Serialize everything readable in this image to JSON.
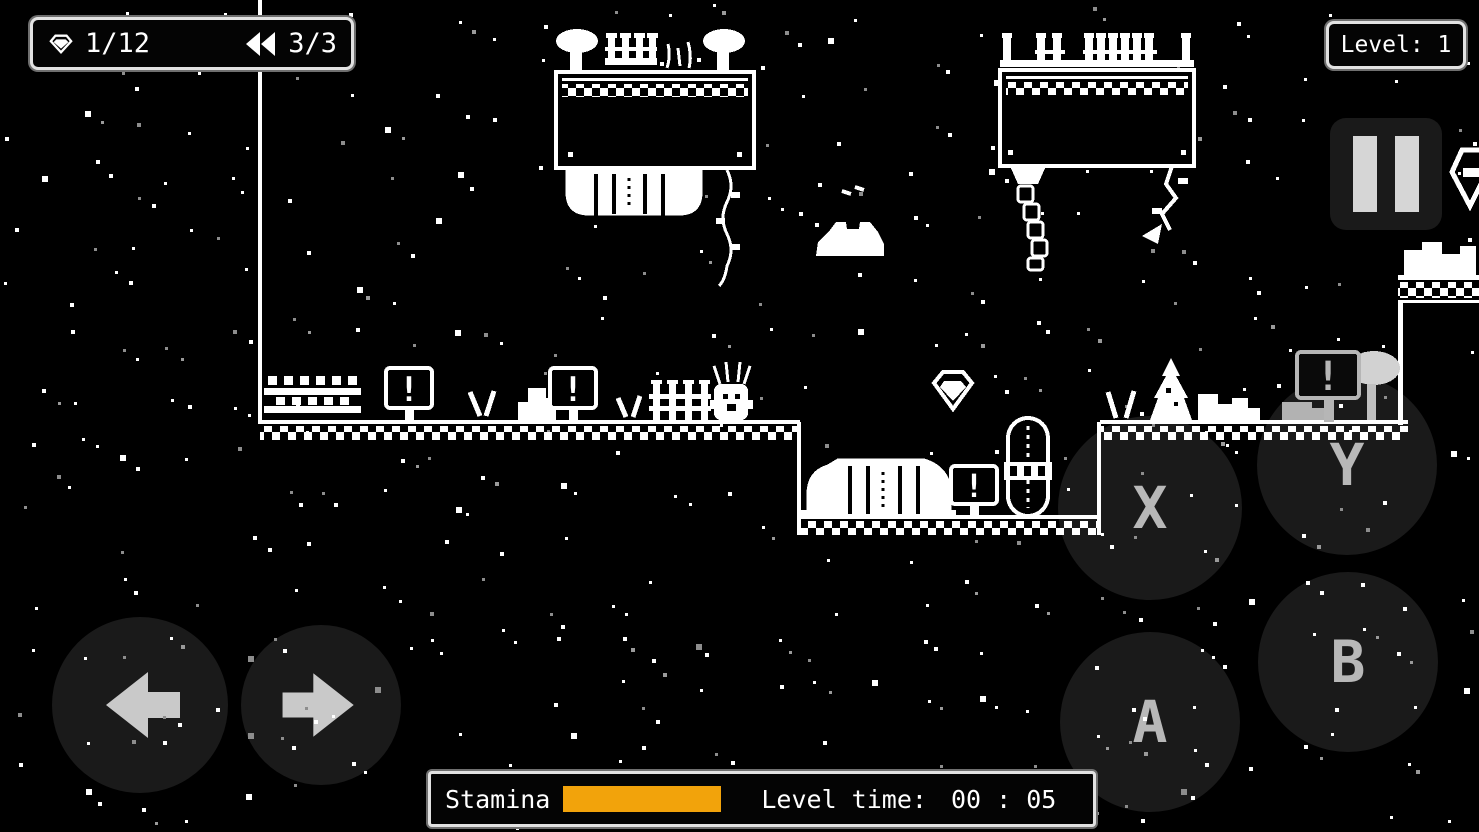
{
  "hud": {
    "gem_counter": "1/12",
    "rewind_counter": "3/3",
    "level_label": "Level: 1",
    "stamina_label": "Stamina",
    "stamina_percent": 100,
    "stamina_color": "#F2A30B",
    "time_label": "Level time:",
    "time_value": "00 : 05"
  },
  "controls": {
    "btn_x": "X",
    "btn_y": "Y",
    "btn_a": "A",
    "btn_b": "B"
  },
  "world": {
    "warning_sign_glyph": "!"
  },
  "icons": {
    "gem": "faceted-diamond-outline",
    "rewind": "double-left-triangles",
    "pause": "two-vertical-bars",
    "dpad_left": "arrow-left",
    "dpad_right": "arrow-right",
    "offscreen_pickup": "clipped-gem-at-screen-edge"
  }
}
